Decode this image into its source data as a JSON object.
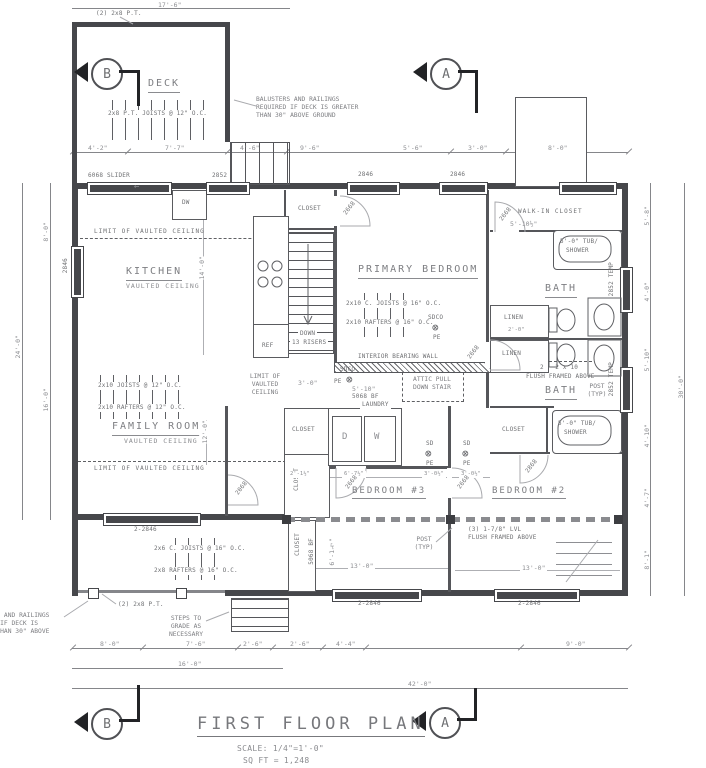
{
  "plan": {
    "title": "FIRST FLOOR PLAN",
    "scale_note": "SCALE: 1/4\"=1'-0\"",
    "sqft_note": "SQ FT = 1,248"
  },
  "markers": {
    "a": "A",
    "b": "B"
  },
  "rooms": {
    "deck": "DECK",
    "kitchen": "KITCHEN",
    "kitchen_sub": "VAULTED CEILING",
    "family": "FAMILY ROOM",
    "family_sub": "VAULTED CEILING",
    "primary": "PRIMARY BEDROOM",
    "bath": "BATH",
    "bed3": "BEDROOM #3",
    "bed2": "BEDROOM #2",
    "wic": "WALK-IN CLOSET",
    "laundry": "LAUNDRY",
    "closet": "CLOSET",
    "linen": "LINEN"
  },
  "appliances": {
    "dw": "DW",
    "ref": "REF",
    "dryer": "D",
    "washer": "W"
  },
  "fixtures": {
    "tub_line1": "5'-0\" TUB/",
    "tub_line2": "SHOWER"
  },
  "stairs": {
    "down": "DOWN",
    "risers": "13 RISERS"
  },
  "symbols": {
    "sd": "SD",
    "pe": "PE",
    "sdco": "SDCO",
    "cross": "⊗"
  },
  "notes": {
    "balusters": "BALUSTERS AND RAILINGS REQUIRED IF DECK IS GREATER THAN 30\" ABOVE GROUND",
    "steps": "STEPS TO GRADE AS NECESSARY",
    "deck_beam": "(2) 2x8 P.T.",
    "deck_joists": "2x8 P.T. JOISTS @ 12\" O.C.",
    "primary_joists": "2x10 C. JOISTS @ 16\" O.C.",
    "primary_rafters": "2x10 RAFTERS @ 16\" O.C.",
    "family_joists": "2x10 JOISTS @ 12\" O.C.",
    "family_rafters": "2x10 RAFTERS @ 12\" O.C.",
    "porch_joists": "2x6 C. JOISTS @ 16\" O.C.",
    "porch_rafters": "2x8 RAFTERS @ 16\" O.C.",
    "bearing_wall": "INTERIOR BEARING WALL",
    "attic": "ATTIC PULL DOWN STAIR",
    "limit_vaulted": "LIMIT OF VAULTED CEILING",
    "flush_2x10_l1": "2 - 2 x 10",
    "flush_2x10_l2": "FLUSH FRAMED ABOVE",
    "flush_lvl_l1": "(3) 1-7/8\" LVL",
    "flush_lvl_l2": "FLUSH FRAMED ABOVE",
    "post": "POST (TYP)",
    "slider_arrow": "←"
  },
  "windows": {
    "slider": "6068 SLIDER",
    "w2852": "2852",
    "w2846": "2846",
    "w2846x2": "2-2846",
    "temp": "2852 TEMP"
  },
  "doors": {
    "d2668": "2668",
    "d2068": "2068",
    "d2868": "2868",
    "bifold": "5068 BF"
  },
  "dims": {
    "deck_width": "17'-6\"",
    "top": [
      "4'-2\"",
      "7'-7\"",
      "4'-6\"",
      "9'-6\"",
      "5'-6\"",
      "3'-0\"",
      "8'-0\""
    ],
    "bottom_row1": [
      "8'-0\"",
      "7'-6\"",
      "2'-6\"",
      "2'-6\"",
      "4'-4\"",
      "9'-0\""
    ],
    "bottom_row2": "16'-0\"",
    "bottom_row3": "42'-0\"",
    "left": [
      "8'-0\"",
      "16'-0\""
    ],
    "left_total": "24'-0\"",
    "right": [
      "5'-8\"",
      "4'-0\"",
      "5'-10\"",
      "4'-10\"",
      "4'-7\"",
      "8'-1\""
    ],
    "right_total": "30'-0\"",
    "kitchen_depth": "14'-0\"",
    "family_depth": "12'-0\"",
    "wic_width": "5'-10½\"",
    "laundry_width": "5'-10\"",
    "linen_depth": "2'-0\"",
    "hall": "3'-0\"",
    "bed3_row": [
      "2'-1½\"",
      "6'-7½\"",
      "3'-0½\"",
      "3'-0½\""
    ],
    "bed3_width": "13'-0\"",
    "bed2_width": "13'-0\"",
    "bed3_depth": "6'-1½\""
  }
}
